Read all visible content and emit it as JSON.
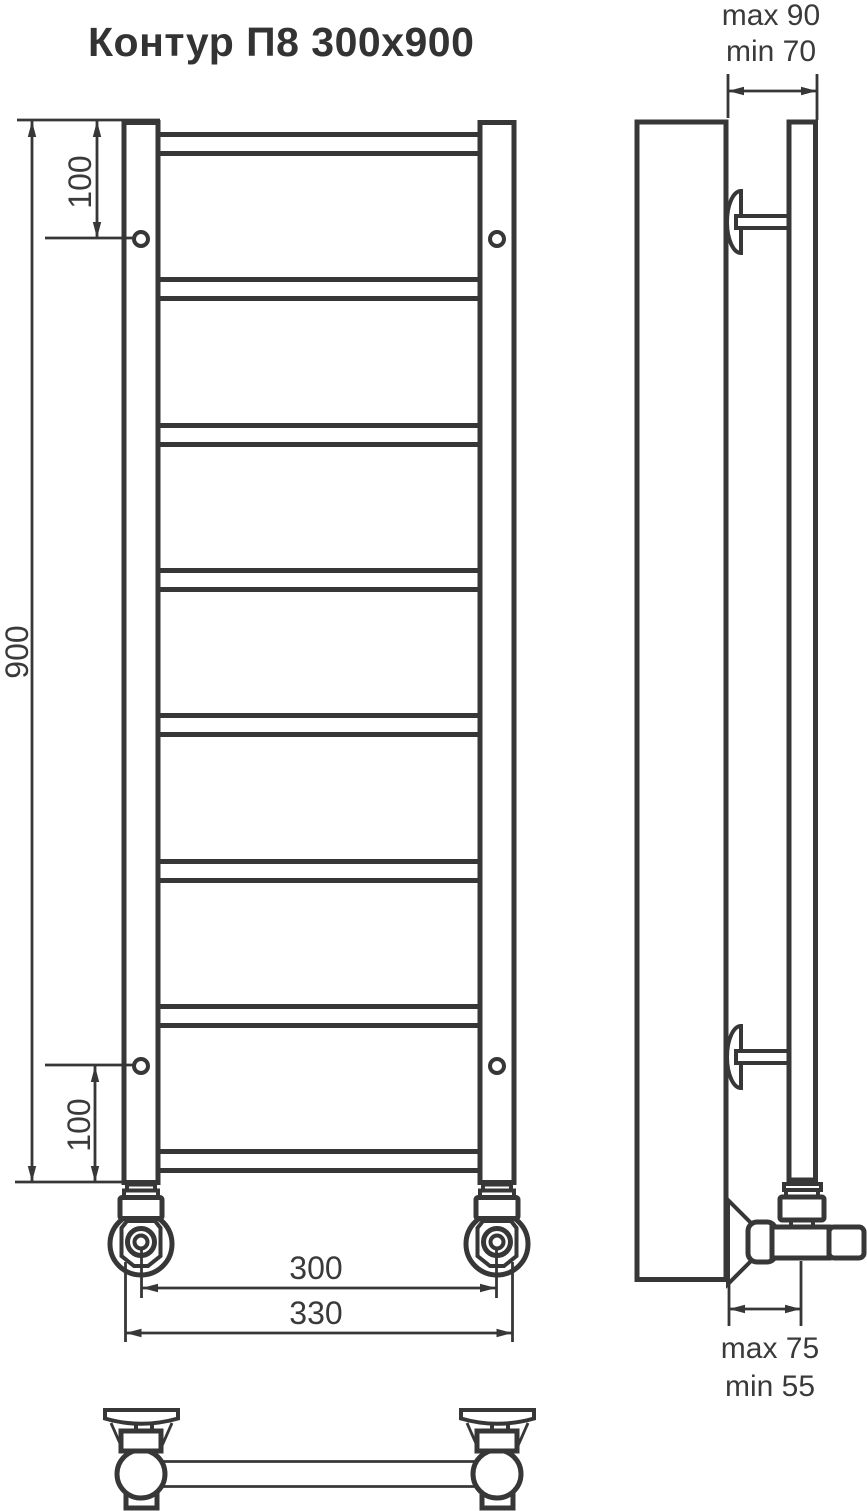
{
  "title": "Контур П8 300x900",
  "product": {
    "model": "Контур П8",
    "size": "300x900",
    "rungs_count": 8
  },
  "dimensions": {
    "height": "900",
    "top_bracket_offset": "100",
    "bottom_bracket_offset": "100",
    "connection_spacing": "300",
    "overall_width": "330",
    "wall_clearance_top_max": "max 90",
    "wall_clearance_top_min": "min 70",
    "wall_clearance_bottom_max": "max 75",
    "wall_clearance_bottom_min": "min 55"
  },
  "colors": {
    "line": "#373737",
    "wall_fill": "#e9eaea",
    "background": "#ffffff",
    "text": "#3a3a3a"
  }
}
